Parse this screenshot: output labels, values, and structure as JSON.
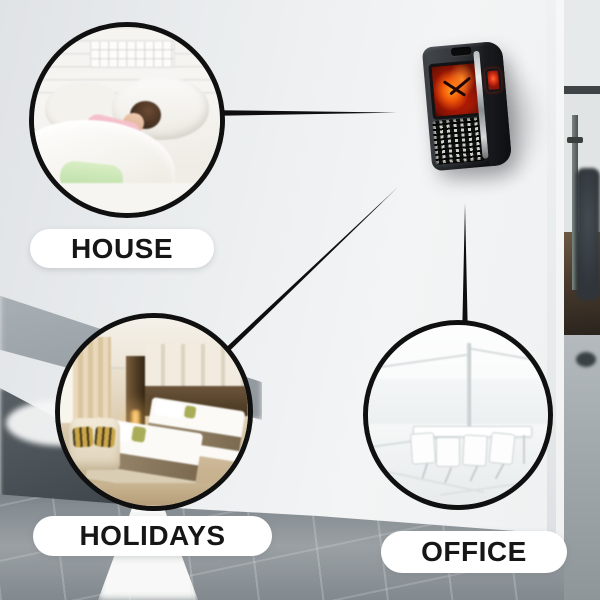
{
  "page": {
    "type": "product-marketing-image",
    "subject": "wall-outlet-flame-heater"
  },
  "callouts": [
    {
      "id": "house",
      "label": "HOUSE",
      "photo": "child-sleeping-in-white-bedroom"
    },
    {
      "id": "holidays",
      "label": "HOLIDAYS",
      "photo": "hotel-twin-bed-room"
    },
    {
      "id": "office",
      "label": "OFFICE",
      "photo": "bright-white-meeting-room"
    }
  ],
  "colors": {
    "line": "#0e0e0e",
    "pill_bg": "#ffffff",
    "label_text": "#161616",
    "circle_border": "#101010",
    "wall": "#edeff0",
    "floor": "#8d9499",
    "heater_body": "#2b2f33",
    "flame_red": "#d32808",
    "flame_orange": "#ff9b1c",
    "button_red": "#e03416",
    "chrome": "#d7d9da"
  }
}
